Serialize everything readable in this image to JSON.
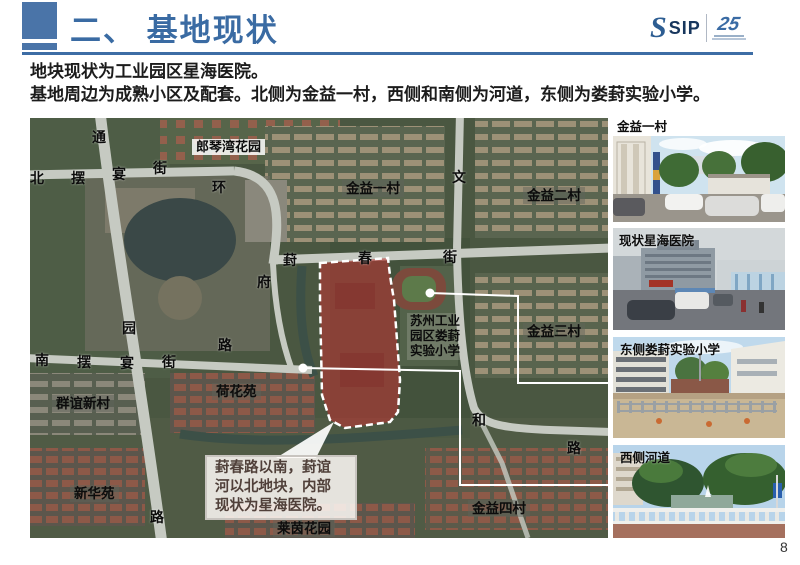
{
  "header": {
    "title": "二、 基地现状",
    "logo": {
      "s": "S",
      "sip": "SIP",
      "anniversary": "25"
    },
    "accent_color": "#4a74a8",
    "title_color": "#3a6ba3"
  },
  "intro": {
    "line1": "地块现状为工业园区星海医院。",
    "line2": "基地周边为成熟小区及配套。北侧为金益一村，西侧和南侧为河道，东侧为娄葑实验小学。"
  },
  "map": {
    "site_fill_color": "#c23333",
    "note": "葑春路以南，葑谊\n河以北地块，内部\n现状为星海医院。",
    "labels": [
      "通",
      "北",
      "摆",
      "宴",
      "街",
      "环",
      "郎琴湾花园",
      "金益一村",
      "文",
      "金益二村",
      "葑",
      "春",
      "街",
      "府",
      "苏州工业\n园区娄葑\n实验小学",
      "金益三村",
      "园",
      "路",
      "南",
      "摆",
      "宴",
      "街",
      "群谊新村",
      "荷花苑",
      "和",
      "路",
      "新华苑",
      "路",
      "金益四村",
      "莱茵花园"
    ]
  },
  "photos": [
    {
      "label": "金益一村"
    },
    {
      "label": "现状星海医院"
    },
    {
      "label": "东侧娄葑实验小学"
    },
    {
      "label": "西侧河道"
    }
  ],
  "page_number": "8"
}
